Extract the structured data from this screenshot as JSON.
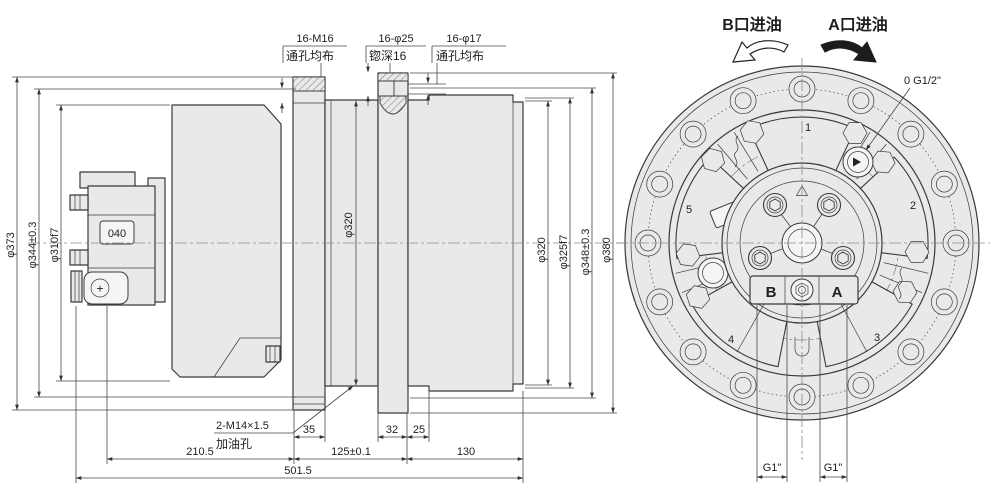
{
  "colors": {
    "body_fill": "#e9e9e7",
    "line": "#3a3a3a",
    "dim": "#474747",
    "centerline": "#8a8a8a"
  },
  "side_view": {
    "top_callouts": [
      {
        "line1": "16-M16",
        "line2": "通孔均布"
      },
      {
        "line1": "16-φ25",
        "line2": "锪深16"
      },
      {
        "line1": "16-φ17",
        "line2": "通孔均布"
      }
    ],
    "left_dims": [
      "φ373",
      "φ344±0.3",
      "φ310f7"
    ],
    "right_dims": [
      "φ320",
      "φ325f7",
      "φ348±0.3",
      "φ380"
    ],
    "bore_dim": "φ320",
    "block_label": "040",
    "plus_label": "+",
    "oil_callout": {
      "line1": "2-M14×1.5",
      "line2": "加油孔"
    },
    "width_dims": [
      "35",
      "32",
      "25"
    ],
    "length_dims": [
      "210.5",
      "125±0.1",
      "130"
    ],
    "overall_length": "501.5"
  },
  "end_view": {
    "rotation_b": "B口进油",
    "rotation_a": "A口进油",
    "gauge_port": "0 G1/2\"",
    "piston_numbers": [
      "1",
      "2",
      "3",
      "4",
      "5"
    ],
    "port_letters": [
      "B",
      "A"
    ],
    "bottom_port_dims": [
      "G1\"",
      "G1\""
    ]
  }
}
